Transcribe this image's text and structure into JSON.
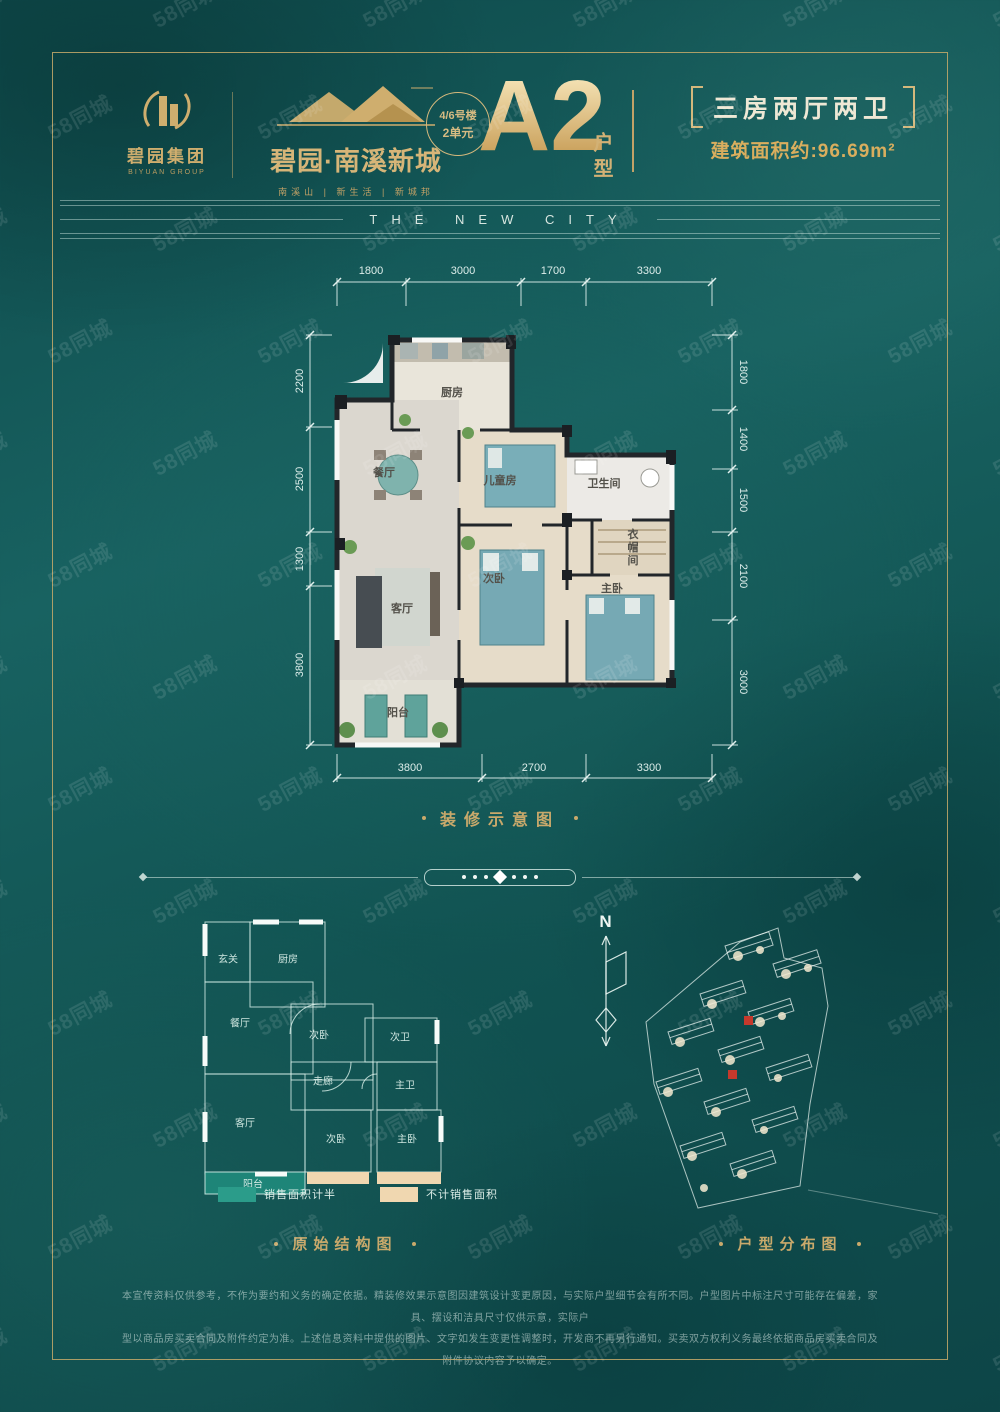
{
  "watermark": {
    "text": "58同城"
  },
  "header": {
    "logo": {
      "name": "碧园集团",
      "name_en": "BIYUAN GROUP"
    },
    "brand": {
      "name": "碧园·南溪新城",
      "tagline": "南溪山 | 新生活 | 新城邦"
    },
    "unit_badge": {
      "line1": "4/6号楼",
      "line2": "2单元"
    },
    "plan": {
      "code": "A2",
      "code_label": "户型"
    },
    "spec": {
      "rooms": "三房两厅两卫",
      "area": "建筑面积约:96.69m²"
    }
  },
  "banner": {
    "text": "THE NEW CITY"
  },
  "decorated_plan": {
    "caption": "装修示意图",
    "dims": {
      "top": [
        "1800",
        "3000",
        "1700",
        "3300"
      ],
      "left": [
        "2200",
        "2500",
        "1300",
        "3800"
      ],
      "right": [
        "1800",
        "1400",
        "1500",
        "2100",
        "3000"
      ],
      "bottom": [
        "3800",
        "2700",
        "3300"
      ]
    },
    "rooms": {
      "kitchen": "厨房",
      "dining": "餐厅",
      "kids_room": "儿童房",
      "bathroom": "卫生间",
      "cloakroom": "衣帽间",
      "living": "客厅",
      "second_bedroom": "次卧",
      "master_bedroom": "主卧",
      "balcony": "阳台"
    }
  },
  "structure_plan": {
    "caption": "原始结构图",
    "rooms": {
      "entry": "玄关",
      "kitchen": "厨房",
      "dining": "餐厅",
      "bedroom_mid": "次卧",
      "bath_second": "次卫",
      "corridor": "走廊",
      "bath_master": "主卫",
      "living": "客厅",
      "bedroom_bottom": "次卧",
      "master": "主卧",
      "balcony": "阳台"
    },
    "legend": [
      {
        "label": "销售面积计半",
        "color": "#2b9c8a"
      },
      {
        "label": "不计销售面积",
        "color": "#f0d7b0"
      }
    ]
  },
  "site_plan": {
    "caption": "户型分布图",
    "north": "N",
    "highlight_color": "#c6392c"
  },
  "footer": {
    "line1": "本宣传资料仅供参考，不作为要约和义务的确定依据。精装修效果示意图因建筑设计变更原因，与实际户型细节会有所不同。户型图片中标注尺寸可能存在偏差，家具、摆设和洁具尺寸仅供示意，实际户",
    "line2": "型以商品房买卖合同及附件约定为准。上述信息资料中提供的图片、文字如发生变更性调整时，开发商不再另行通知。买卖双方权利义务最终依据商品房买卖合同及附件协议内容予以确定。"
  },
  "colors": {
    "background": "#11514f",
    "gold": "#c9a96b",
    "dim_line": "#dff0ea",
    "plan_wall": "#1b1f23",
    "balcony_fill": "#1e8578"
  }
}
